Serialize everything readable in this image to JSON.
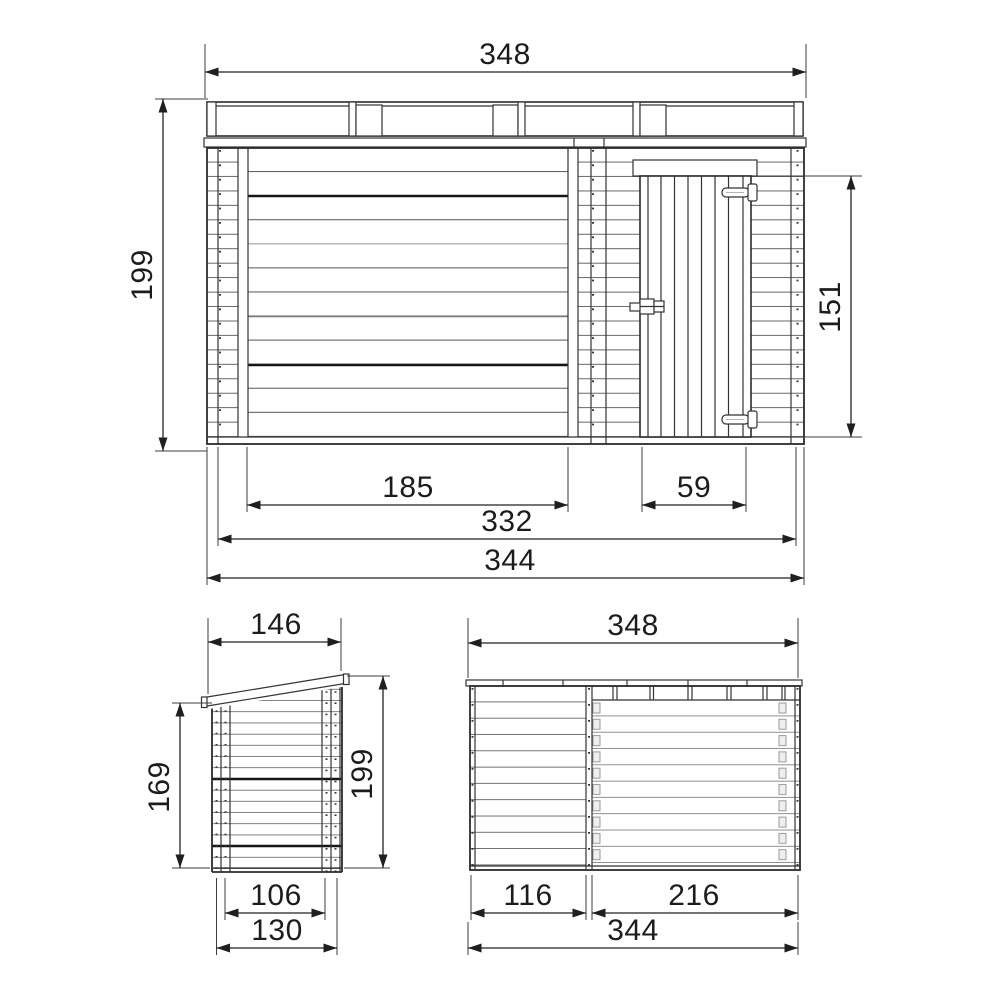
{
  "views": {
    "front": {
      "roof_width": "348",
      "height": "199",
      "door_height": "151",
      "plank_wall_width": "185",
      "door_width": "59",
      "inner_width": "332",
      "overall_width": "344"
    },
    "side": {
      "roof_depth": "146",
      "wall_height": "169",
      "overall_height": "199",
      "inner_depth": "106",
      "overall_depth": "130"
    },
    "rear": {
      "roof_width": "348",
      "left_section_width": "116",
      "right_section_width": "216",
      "overall_width": "344"
    }
  }
}
